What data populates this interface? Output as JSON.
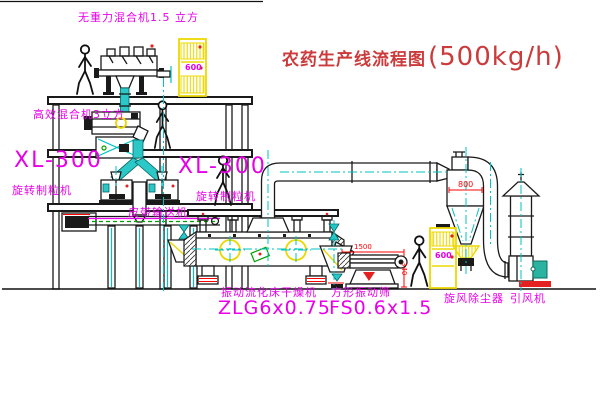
{
  "title": {
    "name_cn": "农药生产线流程图",
    "capacity": "(500kg/h)"
  },
  "machines": {
    "gravityless_mixer": "无重力混合机1.5 立方",
    "high_eff_mixer": "高效混合机3立方",
    "granulator_left_model": "XL-300",
    "granulator_left_name": "旋转制粒机",
    "granulator_right_model": "XL-300",
    "granulator_right_name": "旋转制粒机",
    "belt_conveyor": "皮带输送机",
    "dryer_name": "振动流化床干燥机",
    "dryer_model": "ZLG6x0.75",
    "sieve_name": "方形振动筛",
    "sieve_model": "FS0.6x1.5",
    "cyclone_name": "旋风除尘器",
    "fan_name": "引风机"
  },
  "dimensions": {
    "cyclone_width": "800",
    "sieve_length": "1500",
    "sieve_height": "340"
  },
  "cabinets": {
    "panel_marking": "600"
  },
  "colors": {
    "label_magenta": "#e800e8",
    "dimension_red": "#ff0000",
    "title_red": "#cc3b3b",
    "centerline_cyan": "#00c3c3",
    "cabinet_yellow": "#ecd800",
    "equipment_black": "#1a1a1a",
    "motor_green": "#00a000",
    "background": "#ffffff"
  }
}
